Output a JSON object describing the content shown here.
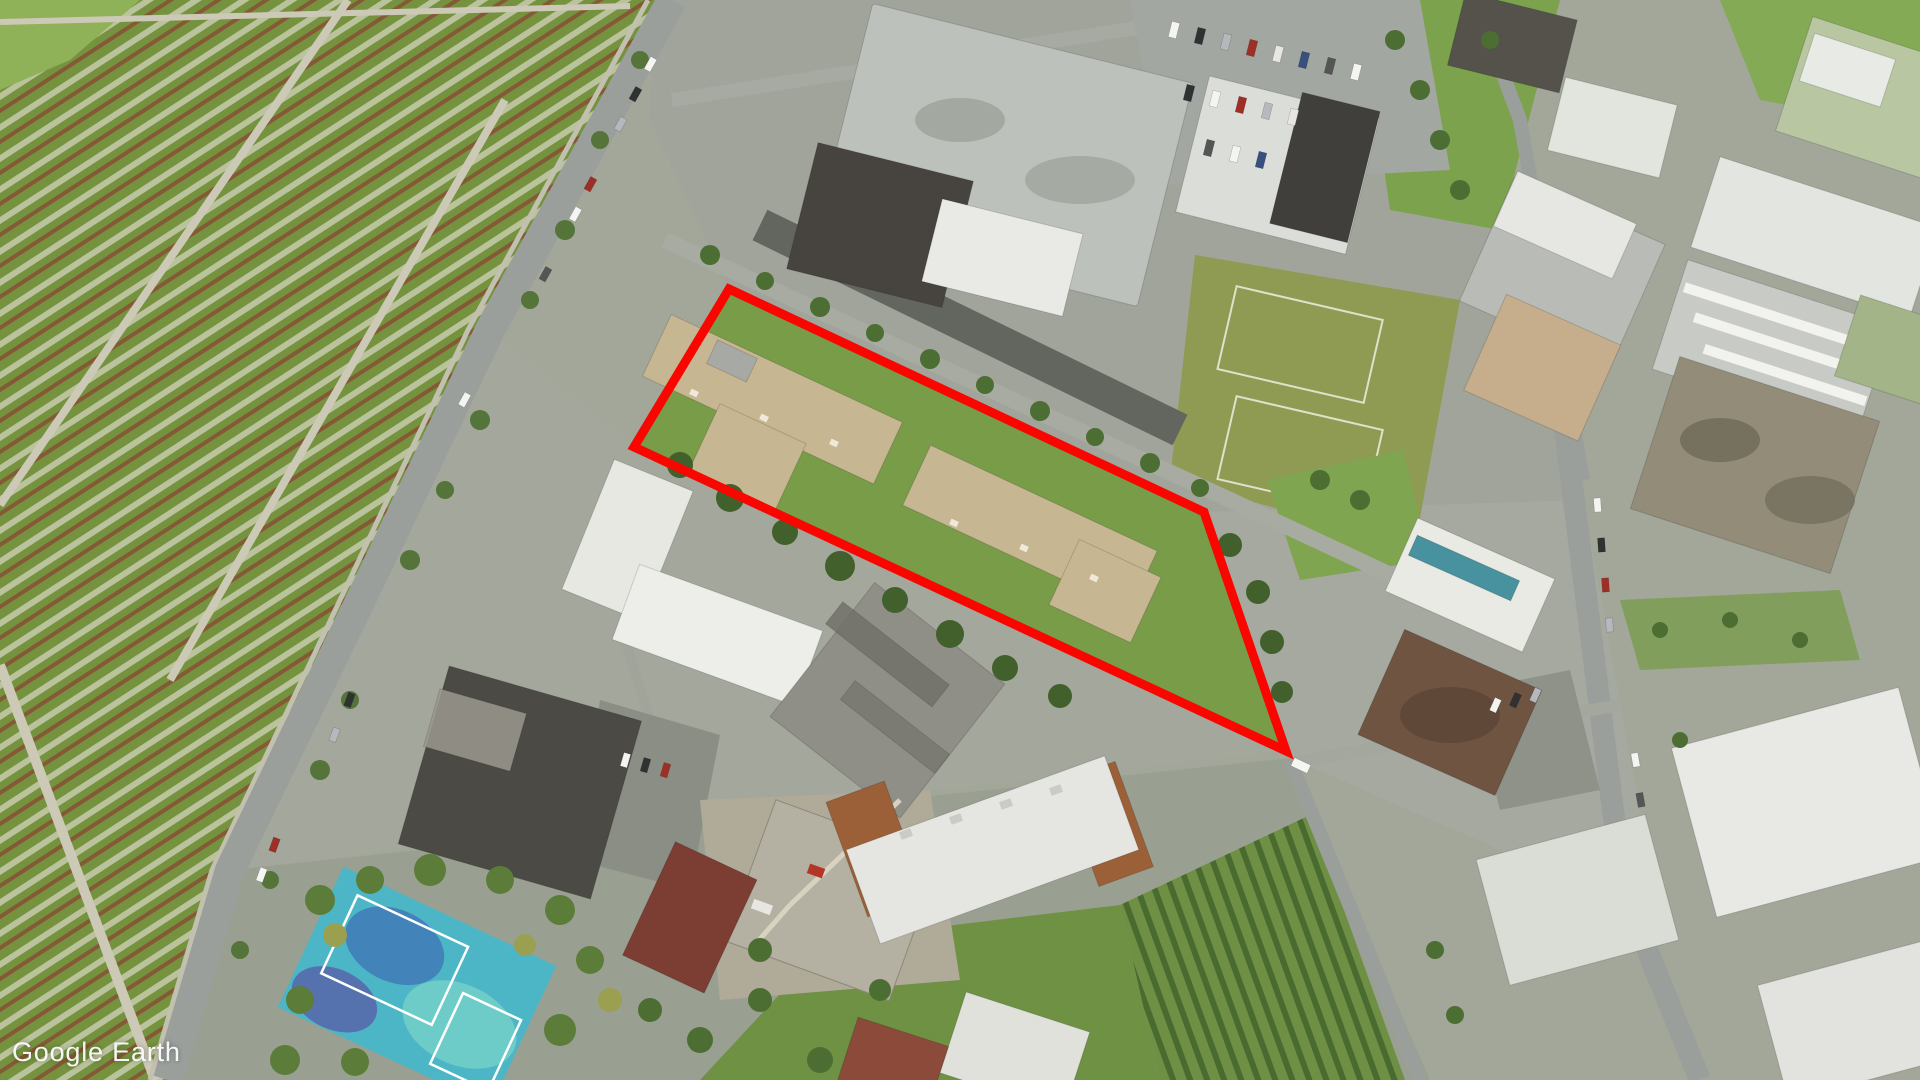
{
  "app": {
    "watermark": "Google Earth"
  },
  "viewport": {
    "width": 1920,
    "height": 1080,
    "view_type": "aerial-satellite-imagery"
  },
  "overlay": {
    "parcel_polygon_points": "729,289 1204,512 1286,751 634,447",
    "color": "#f90600",
    "stroke_width": 9
  },
  "scene": {
    "semantic_regions": [
      "cemetery-with-headstone-rows",
      "main-diagonal-street",
      "highlighted-parcel-with-two-tan-apartment-buildings",
      "commercial-flat-roof-buildings",
      "surface-parking-lot",
      "sports-fields",
      "construction-site-with-crane",
      "painted-blue-playground-courts",
      "allotment-gardens",
      "condo-blocks-east"
    ]
  },
  "colors": {
    "parcel_outline": "#f90600",
    "cemetery_green": "#75923f",
    "lawn_green": "#789c48",
    "road_gray": "#9b9f9c",
    "roof_tan": "#c7b692",
    "roof_white": "#e8e9e4",
    "roof_dark": "#4c4a45",
    "playground_teal": "#4cb6c6",
    "watermark_text": "#ffffff"
  }
}
